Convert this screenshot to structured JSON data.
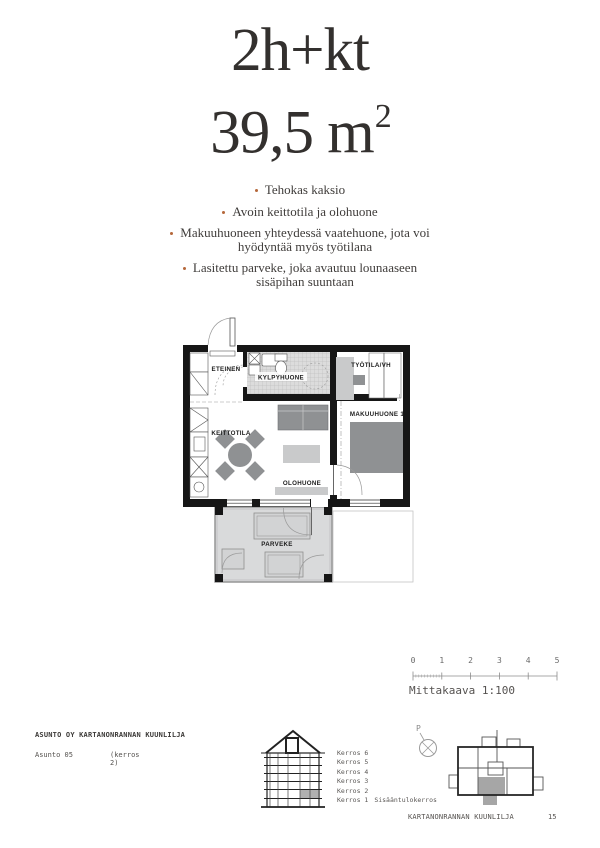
{
  "header": {
    "type_label": "2h+kt",
    "area_value": "39,5 m",
    "area_superscript": "2"
  },
  "highlights": {
    "bullet_color": "#b5673a",
    "items": [
      "Tehokas kaksio",
      "Avoin keittotila ja olohuone",
      "Makuuhuoneen yhteydessä vaatehuone, jota voi\nhyödyntää myös työtilana",
      "Lasitettu parveke, joka avautuu lounaaseen\nsisäpihan suuntaan"
    ]
  },
  "floor_plan": {
    "rooms": {
      "eteinen": "ETEINEN",
      "kylpyhuone": "KYLPYHUONE",
      "tyotila": "TYÖTILA/VH",
      "makuuhuone": "MAKUUHUONE 1",
      "keittotila": "KEITTOTILA",
      "olohuone": "OLOHUONE",
      "parveke": "PARVEKE"
    },
    "wall_color": "#161616",
    "furniture_dark": "#8f9193",
    "furniture_light": "#c9cacb",
    "balcony_floor": "#d9dadb"
  },
  "scale_bar": {
    "ticks": [
      "0",
      "1",
      "2",
      "3",
      "4",
      "5"
    ],
    "label": "Mittakaava 1:100"
  },
  "project": {
    "company": "ASUNTO OY KARTANONRANNAN KUUNLILJA",
    "apartment": "Asunto 05",
    "floor_note": "(kerros 2)"
  },
  "section_diagram": {
    "floors": [
      "Kerros 6",
      "Kerros 5",
      "Kerros 4",
      "Kerros 3",
      "Kerros 2",
      "Kerros 1"
    ],
    "entry_note": "Sisääntulokerros",
    "highlighted_floor": "Kerros 2",
    "highlight_color": "#b0b0b0"
  },
  "compass": {
    "north_label": "P"
  },
  "footer": {
    "project_name": "KARTANONRANNAN KUUNLILJA",
    "page_number": "15"
  }
}
